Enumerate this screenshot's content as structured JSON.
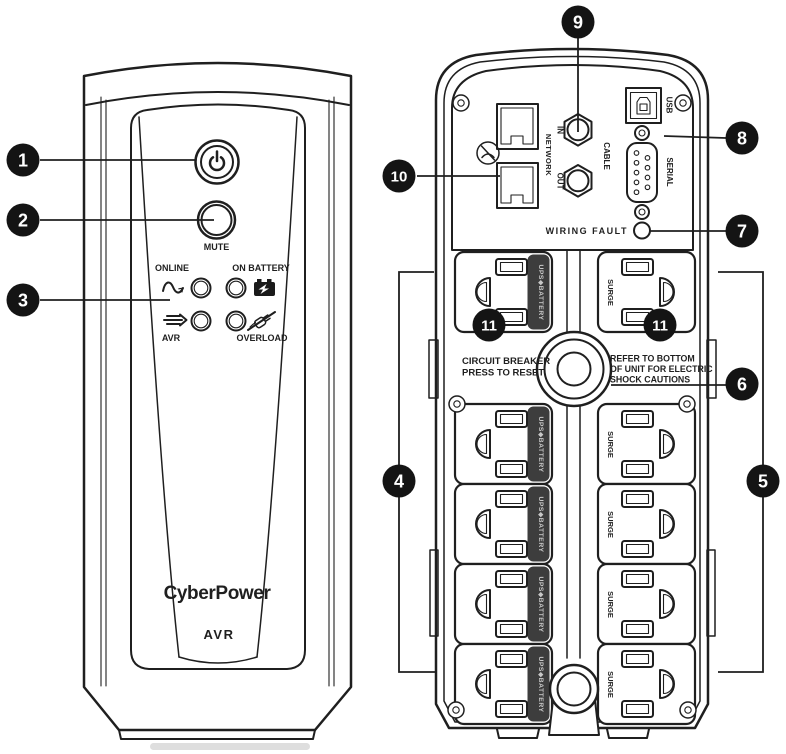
{
  "callouts": {
    "c1": "1",
    "c2": "2",
    "c3": "3",
    "c4": "4",
    "c5": "5",
    "c6": "6",
    "c7": "7",
    "c8": "8",
    "c9": "9",
    "c10": "10",
    "c11": "11"
  },
  "front": {
    "mute_label": "MUTE",
    "indicator_online": "ONLINE",
    "indicator_on_battery": "ON BATTERY",
    "indicator_avr": "AVR",
    "indicator_overload": "OVERLOAD",
    "brand_logo": "CyberPower",
    "model_label": "AVR"
  },
  "back": {
    "network_label": "NETWORK",
    "network_in_label": "IN",
    "network_out_label": "OUT",
    "cable_label": "CABLE",
    "usb_label": "USB",
    "serial_label": "SERIAL",
    "wiring_fault_label": "WIRING FAULT",
    "circuit_breaker_line1": "CIRCUIT BREAKER",
    "circuit_breaker_line2": "PRESS TO RESET",
    "caution_line1": "REFER TO BOTTOM",
    "caution_line2": "OF UNIT FOR ELECTRIC",
    "caution_line3": "SHOCK CAUTIONS",
    "battery_outlet_label": "UPS◆BATTERY",
    "surge_outlet_label": "SURGE"
  },
  "colors": {
    "line": "#1f1f1f",
    "callout_bg": "#141414",
    "callout_text": "#ffffff",
    "strip_bg": "#3d3d3d",
    "strip_text": "#c9c9c9",
    "background": "#ffffff"
  }
}
